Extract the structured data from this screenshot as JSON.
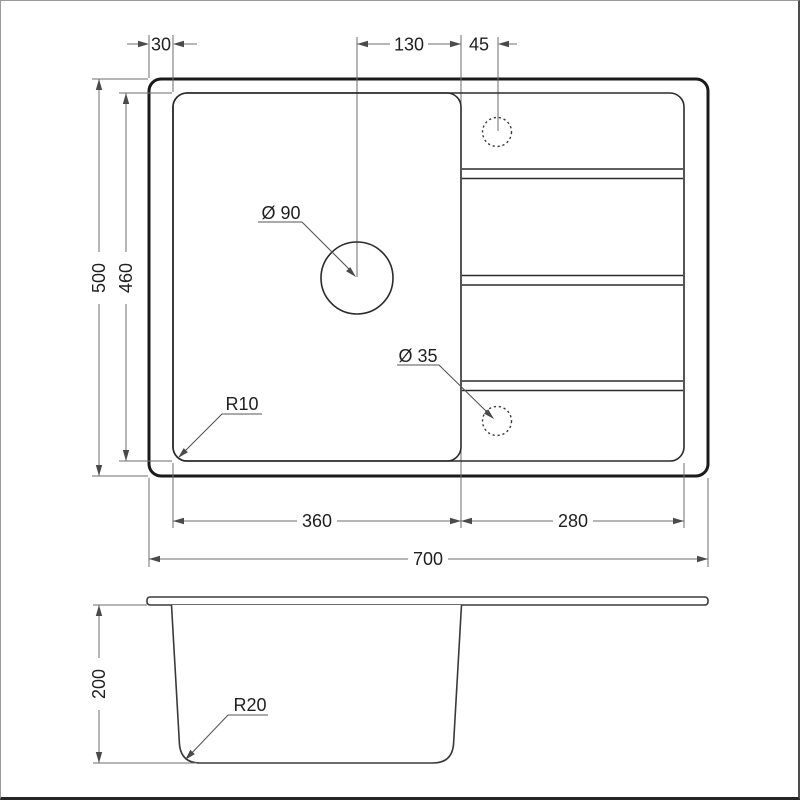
{
  "meta": {
    "description": "Technical dimension drawing of a kitchen sink with bowl and drainboard: top view and side section view"
  },
  "colors": {
    "line": "#2b2b2b",
    "thin_line": "#6e6e6e",
    "text": "#1f1f1f",
    "background": "#ffffff"
  },
  "dims": {
    "rim_offset": "30",
    "drain_to_divider": "130",
    "divider_to_hole": "45",
    "outer_depth": "500",
    "inner_depth": "460",
    "drain_diameter": "Ø 90",
    "hole_diameter": "Ø 35",
    "corner_radius": "R10",
    "bowl_width": "360",
    "drainboard_width": "280",
    "outer_width": "700",
    "bowl_depth": "200",
    "bottom_radius": "R20"
  }
}
